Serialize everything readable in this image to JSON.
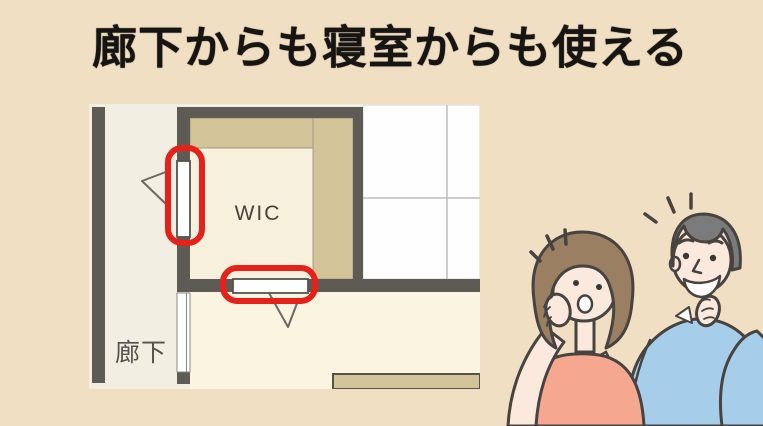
{
  "page": {
    "background": "#f1dfc4"
  },
  "title": {
    "text": "廊下からも寝室からも使える",
    "color": "#171512"
  },
  "floorplan": {
    "labels": {
      "closet": "WIC",
      "hallway": "廊下"
    },
    "colors": {
      "wall": "#5e5b55",
      "hallway_floor": "#f3eee2",
      "wic_floor": "#f7f0dc",
      "bedroom_floor": "#faf4e0",
      "closet_strip": "#d3c399",
      "grid_room": "#fefefe",
      "grid_line": "#bdbdbd",
      "door": "#ffffff",
      "highlight": "#e6211a",
      "swing_line": "#6b6862"
    }
  },
  "illustration": {
    "description": "surprised woman and thinking man looking at the floor plan",
    "colors": {
      "skin": "#fce9de",
      "outline": "#474340",
      "woman_hair": "#9a7f63",
      "woman_top": "#f5a78f",
      "man_hair": "#7b7b7b",
      "man_sweater": "#a6cdea",
      "mouth": "#ffffff",
      "highlight_gap": "#fdfdfd"
    }
  }
}
